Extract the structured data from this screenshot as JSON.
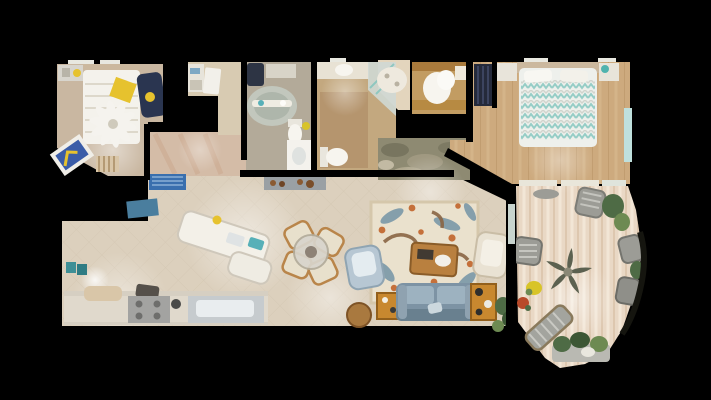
{
  "app": {
    "view_type": "top-down-3d-dollhouse-floorplan",
    "background": "#000000"
  },
  "scene": {
    "rooms": [
      "bedroom-1",
      "hall-closet",
      "bathroom-1",
      "bathroom-2",
      "walk-in-closet",
      "master-bedroom",
      "hallway",
      "kitchen",
      "dining-area",
      "living-room",
      "lanai-balcony",
      "laundry-nook"
    ],
    "furniture": [
      "bed-1",
      "ceiling-fan-1",
      "yellow-pillow",
      "navy-accent-chair",
      "leaning-artwork",
      "striped-bench",
      "bathtub-1",
      "toilet-1",
      "vanity-1",
      "corner-tub",
      "shower-glass",
      "toilet-2",
      "vanity-2",
      "entry-console-with-shoes",
      "linen-pile",
      "master-bed",
      "nightstand-left",
      "nightstand-right",
      "kitchen-island",
      "island-sink",
      "range-cooktop",
      "kitchen-sink-counter",
      "blue-runner-rug",
      "teal-door-mat",
      "dining-table",
      "dining-chairs",
      "blue-armchair",
      "cream-armchair",
      "botanical-area-rug",
      "coffee-table",
      "blue-sofa",
      "orange-bar-cabinet",
      "orange-console",
      "wood-ottoman",
      "palm-ceiling-fan",
      "wicker-patio-chair",
      "patio-chaise-lounge",
      "patio-planters",
      "potted-plants",
      "gray-bench"
    ]
  },
  "palette": {
    "background": "#000000",
    "great_room_tile": "#dcd0bd",
    "hallway_tile": "#d4bca7",
    "bedroom1_carpet": "#c9b7a1",
    "bathroom1_floor": "#b3aa99",
    "bathroom2_floor": "#c3a87f",
    "bathroom2_inner": "#b2906a",
    "closet_floor": "#d8cbb2",
    "walkin_closet_floor": "#c29c62",
    "dark_closet": "#252a3b",
    "master_wood": "#cdaa7e",
    "lanai_wood": "#e9d8c5",
    "laundry_mottle": "#8e8a72",
    "rug_base": "#eae1cd",
    "rug_leaf_blue": "#7b98a8",
    "rug_bird_brown": "#8a6544",
    "rug_flower_orange": "#c5703a",
    "sofa_blue": "#7d93a4",
    "sofa_cushion": "#9db2c0",
    "armchair_blue": "#b7c7d3",
    "armchair_cream": "#e9e2d3",
    "dining_chair_cream": "#e8e0cc",
    "dining_wood": "#b9854a",
    "coffee_table_amber": "#b9803f",
    "side_table_orange": "#c8882f",
    "ottoman_wood": "#a9793f",
    "kitchen_island_white": "#f3f0e8",
    "counter_beige": "#d6cfc2",
    "stove_gray": "#a3a3a1",
    "sink_steel": "#c6cbce",
    "bed1_white": "#f4f2ec",
    "pillow_yellow": "#e6c22e",
    "accent_chair_navy": "#2a3550",
    "master_duvet": "#eef0ec",
    "duvet_teal": "#7fc4bd",
    "headboard_taupe": "#cbb89e",
    "nightstand_white": "#e8e4da",
    "fan_blade_white": "#f5f3ee",
    "lanai_fan_leaf": "#5c6150",
    "plant_green": "#4e6b45",
    "plant_green_light": "#6d8a52",
    "patio_gray": "#9c9c96",
    "flower_yellow": "#d8c428",
    "flower_red": "#b84a2a",
    "runner_blue": "#3a6fae",
    "mat_teal": "#4a7e9e",
    "art_teal": "#3e8f96",
    "art_blue": "#3a5ca8",
    "console_gray": "#9aa0a4",
    "tub_gray": "#c2c7bd",
    "fixture_white": "#f7f5ef",
    "window_teal": "#bfe0dd",
    "glass_shower": "#cfd8d4"
  }
}
